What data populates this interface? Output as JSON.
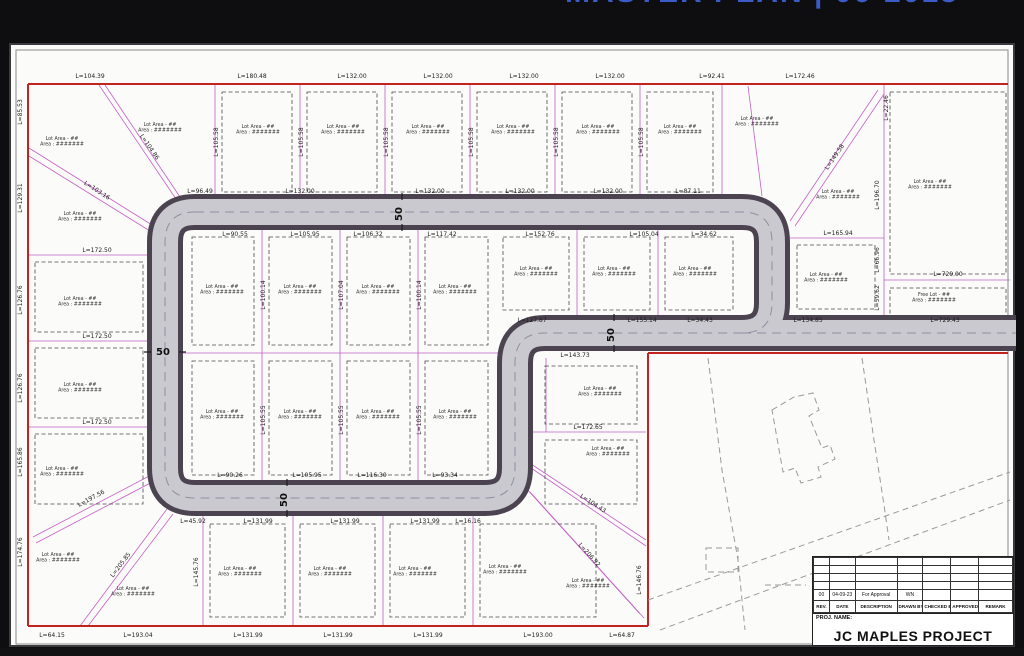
{
  "page": {
    "title": "MASTER PLAN | 06-2013"
  },
  "title_block": {
    "proj_label": "PROJ. NAME:",
    "project_name": "JC MAPLES PROJECT",
    "columns": [
      "REV.",
      "DATE",
      "DESCRIPTION",
      "DRAWN BY",
      "CHECKED BY",
      "APPROVED BY",
      "REMARK"
    ],
    "revision_row": {
      "rev": "00",
      "date": "04-09-23",
      "description": "For Approval",
      "drawn_by": "WN",
      "checked_by": "",
      "approved_by": "",
      "remark": ""
    }
  },
  "plan": {
    "road_width_label": "50",
    "lot_label_line1": "Lot Area - ##",
    "lot_label_line2": "Area : #######",
    "free_lot_line1": "Free Lot - ##",
    "free_lot_line2": "Area : #######",
    "width_markers": [
      {
        "x": 402,
        "y": 214,
        "r": -90
      },
      {
        "x": 163,
        "y": 355
      },
      {
        "x": 287,
        "y": 500,
        "r": -90
      },
      {
        "x": 614,
        "y": 335,
        "r": -90
      }
    ],
    "free_lot_pos": {
      "x": 934,
      "y": 296
    },
    "lot_label_positions": [
      [
        160,
        126
      ],
      [
        258,
        128
      ],
      [
        343,
        128
      ],
      [
        428,
        128
      ],
      [
        513,
        128
      ],
      [
        598,
        128
      ],
      [
        680,
        128
      ],
      [
        757,
        120
      ],
      [
        62,
        140
      ],
      [
        838,
        193
      ],
      [
        826,
        276
      ],
      [
        930,
        183
      ],
      [
        80,
        215
      ],
      [
        80,
        300
      ],
      [
        80,
        386
      ],
      [
        62,
        470
      ],
      [
        58,
        556
      ],
      [
        133,
        590
      ],
      [
        240,
        570
      ],
      [
        330,
        570
      ],
      [
        415,
        570
      ],
      [
        505,
        568
      ],
      [
        588,
        582
      ],
      [
        222,
        288
      ],
      [
        300,
        288
      ],
      [
        378,
        288
      ],
      [
        455,
        288
      ],
      [
        536,
        270
      ],
      [
        614,
        270
      ],
      [
        695,
        270
      ],
      [
        222,
        413
      ],
      [
        300,
        413
      ],
      [
        378,
        413
      ],
      [
        455,
        413
      ],
      [
        600,
        390
      ],
      [
        608,
        450
      ]
    ],
    "dims": [
      {
        "t": "L=104.39",
        "x": 90,
        "y": 78
      },
      {
        "t": "L=180.48",
        "x": 252,
        "y": 78
      },
      {
        "t": "L=132.00",
        "x": 352,
        "y": 78
      },
      {
        "t": "L=132.00",
        "x": 438,
        "y": 78
      },
      {
        "t": "L=132.00",
        "x": 524,
        "y": 78
      },
      {
        "t": "L=132.00",
        "x": 610,
        "y": 78
      },
      {
        "t": "L=92.41",
        "x": 712,
        "y": 78
      },
      {
        "t": "L=172.46",
        "x": 800,
        "y": 78
      },
      {
        "t": "L=85.53",
        "x": 22,
        "y": 112,
        "r": -90
      },
      {
        "t": "L=129.31",
        "x": 22,
        "y": 198,
        "r": -90
      },
      {
        "t": "L=126.76",
        "x": 22,
        "y": 300,
        "r": -90
      },
      {
        "t": "L=126.76",
        "x": 22,
        "y": 388,
        "r": -90
      },
      {
        "t": "L=165.86",
        "x": 22,
        "y": 462,
        "r": -90
      },
      {
        "t": "L=174.76",
        "x": 22,
        "y": 552,
        "r": -90
      },
      {
        "t": "L=64.15",
        "x": 52,
        "y": 637
      },
      {
        "t": "L=193.04",
        "x": 138,
        "y": 637
      },
      {
        "t": "L=131.99",
        "x": 248,
        "y": 637
      },
      {
        "t": "L=131.99",
        "x": 338,
        "y": 637
      },
      {
        "t": "L=131.99",
        "x": 428,
        "y": 637
      },
      {
        "t": "L=193.00",
        "x": 538,
        "y": 637
      },
      {
        "t": "L=64.87",
        "x": 622,
        "y": 637
      },
      {
        "t": "L=22.46",
        "x": 888,
        "y": 108,
        "r": -90
      },
      {
        "t": "L=196.70",
        "x": 879,
        "y": 195,
        "r": -90
      },
      {
        "t": "L=66.96",
        "x": 879,
        "y": 260,
        "r": -90
      },
      {
        "t": "L=59.62",
        "x": 879,
        "y": 298,
        "r": -90
      },
      {
        "t": "L=165.94",
        "x": 838,
        "y": 235
      },
      {
        "t": "L=729.00",
        "x": 948,
        "y": 276
      },
      {
        "t": "L=96.49",
        "x": 200,
        "y": 193
      },
      {
        "t": "L=132.00",
        "x": 300,
        "y": 193
      },
      {
        "t": "L=132.00",
        "x": 430,
        "y": 193
      },
      {
        "t": "L=132.00",
        "x": 520,
        "y": 193
      },
      {
        "t": "L=132.00",
        "x": 608,
        "y": 193
      },
      {
        "t": "L=87.11",
        "x": 688,
        "y": 193
      },
      {
        "t": "L=90.55",
        "x": 235,
        "y": 236
      },
      {
        "t": "L=105.95",
        "x": 305,
        "y": 236
      },
      {
        "t": "L=106.32",
        "x": 368,
        "y": 236
      },
      {
        "t": "L=117.42",
        "x": 442,
        "y": 236
      },
      {
        "t": "L=152.76",
        "x": 540,
        "y": 236
      },
      {
        "t": "L=105.04",
        "x": 644,
        "y": 236
      },
      {
        "t": "L=34.62",
        "x": 704,
        "y": 236
      },
      {
        "t": "L=127.87",
        "x": 532,
        "y": 322
      },
      {
        "t": "L=155.14",
        "x": 642,
        "y": 322
      },
      {
        "t": "L=34.43",
        "x": 700,
        "y": 322
      },
      {
        "t": "L=134.85",
        "x": 808,
        "y": 322
      },
      {
        "t": "L=729.43",
        "x": 945,
        "y": 322
      },
      {
        "t": "L=143.73",
        "x": 575,
        "y": 357
      },
      {
        "t": "L=90.26",
        "x": 230,
        "y": 477
      },
      {
        "t": "L=105.95",
        "x": 307,
        "y": 477
      },
      {
        "t": "L=116.30",
        "x": 372,
        "y": 477
      },
      {
        "t": "L=93.34",
        "x": 445,
        "y": 477
      },
      {
        "t": "L=45.92",
        "x": 193,
        "y": 523
      },
      {
        "t": "L=131.99",
        "x": 258,
        "y": 523
      },
      {
        "t": "L=131.99",
        "x": 345,
        "y": 523
      },
      {
        "t": "L=131.99",
        "x": 425,
        "y": 523
      },
      {
        "t": "L=16.16",
        "x": 468,
        "y": 523
      },
      {
        "t": "L=172.50",
        "x": 97,
        "y": 252
      },
      {
        "t": "L=172.50",
        "x": 97,
        "y": 338
      },
      {
        "t": "L=172.50",
        "x": 97,
        "y": 424
      },
      {
        "t": "L=105.58",
        "x": 218,
        "y": 142,
        "r": -90
      },
      {
        "t": "L=105.58",
        "x": 303,
        "y": 142,
        "r": -90
      },
      {
        "t": "L=105.58",
        "x": 388,
        "y": 142,
        "r": -90
      },
      {
        "t": "L=105.58",
        "x": 473,
        "y": 142,
        "r": -90
      },
      {
        "t": "L=105.58",
        "x": 558,
        "y": 142,
        "r": -90
      },
      {
        "t": "L=105.58",
        "x": 643,
        "y": 142,
        "r": -90
      },
      {
        "t": "L=100.14",
        "x": 265,
        "y": 295,
        "r": -90
      },
      {
        "t": "L=107.04",
        "x": 343,
        "y": 295,
        "r": -90
      },
      {
        "t": "L=100.14",
        "x": 421,
        "y": 295,
        "r": -90
      },
      {
        "t": "L=105.55",
        "x": 265,
        "y": 420,
        "r": -90
      },
      {
        "t": "L=105.55",
        "x": 343,
        "y": 420,
        "r": -90
      },
      {
        "t": "L=105.55",
        "x": 421,
        "y": 420,
        "r": -90
      },
      {
        "t": "L=104.86",
        "x": 148,
        "y": 148,
        "r": 56
      },
      {
        "t": "L=103.16",
        "x": 96,
        "y": 192,
        "r": 33
      },
      {
        "t": "L=149.58",
        "x": 836,
        "y": 158,
        "r": -56
      },
      {
        "t": "L=197.56",
        "x": 92,
        "y": 500,
        "r": -28
      },
      {
        "t": "L=205.85",
        "x": 122,
        "y": 566,
        "r": -53
      },
      {
        "t": "L=145.76",
        "x": 198,
        "y": 572,
        "r": -90
      },
      {
        "t": "L=172.65",
        "x": 588,
        "y": 429
      },
      {
        "t": "L=104.43",
        "x": 592,
        "y": 505,
        "r": 33
      },
      {
        "t": "L=206.92",
        "x": 588,
        "y": 556,
        "r": 48
      },
      {
        "t": "L=146.76",
        "x": 641,
        "y": 580,
        "r": -90
      }
    ]
  },
  "colors": {
    "boundary": "#c3231d",
    "lotLine": "#c560c5",
    "roadEdge": "#4c4350",
    "roadFill": "#cac9cf",
    "title": "#3b5bc7",
    "ink": "#1d1d1d"
  }
}
